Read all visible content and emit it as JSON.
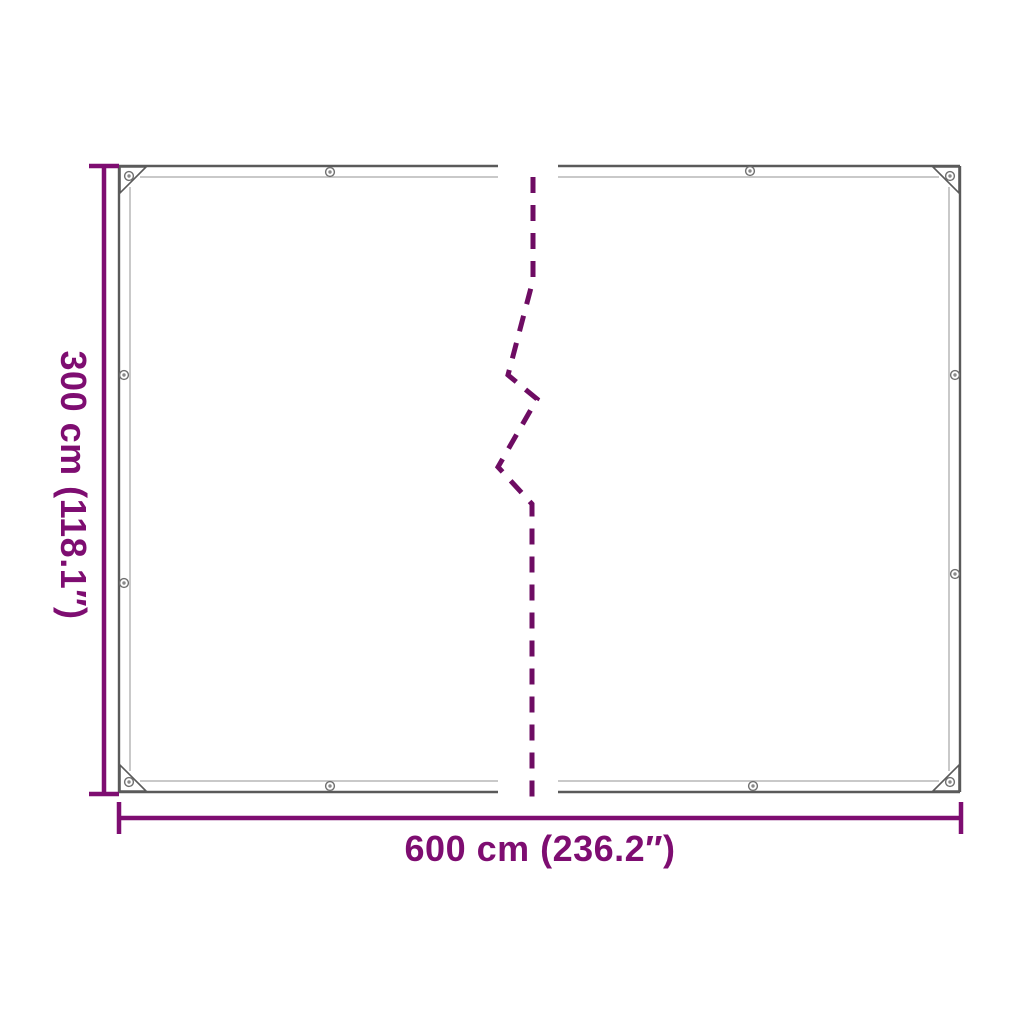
{
  "figure": {
    "background": "#ffffff",
    "description": "Product dimension diagram of a transparent tarpaulin with eyelets, shown broken in the middle to indicate greater length"
  },
  "colors": {
    "dimension": "#7e0d71",
    "break_line": "#6e0c63",
    "outline": "#5a5a5a",
    "hem": "#c9c9c9",
    "grommet_ring": "#6f6f6f",
    "grommet_core": "#8a8a8a"
  },
  "labels": {
    "height": "300 cm (118.1″)",
    "width": "600 cm (236.2″)"
  }
}
